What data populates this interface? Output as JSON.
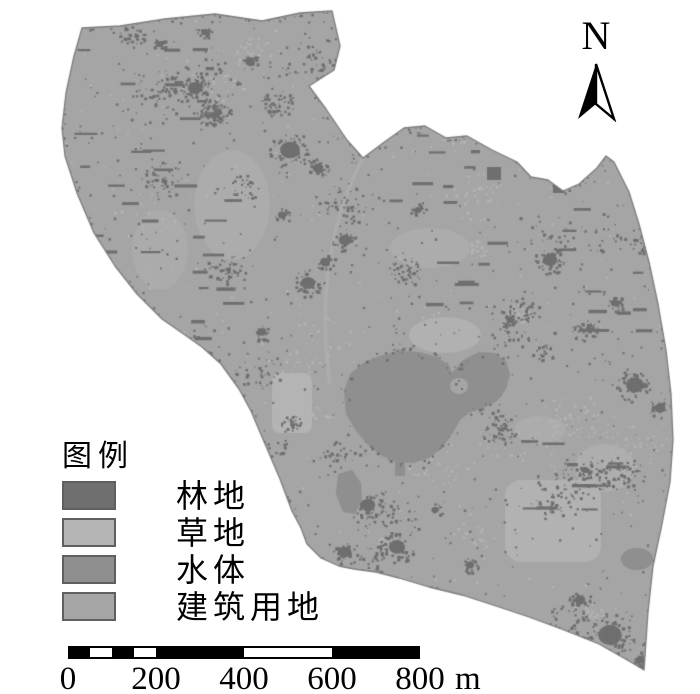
{
  "figure": {
    "type": "land-use-classification-map",
    "north_label": "N",
    "legend": {
      "title": "图例",
      "items": [
        {
          "id": "forest",
          "label": "林地",
          "color": "#6f6f6f"
        },
        {
          "id": "grass",
          "label": "草地",
          "color": "#b4b4b4"
        },
        {
          "id": "water",
          "label": "水体",
          "color": "#8f8f8f"
        },
        {
          "id": "building",
          "label": "建筑用地",
          "color": "#a5a5a5"
        }
      ]
    },
    "scale_bar": {
      "tick_labels": [
        "0",
        "200",
        "400",
        "600",
        "800"
      ],
      "unit": "m",
      "total_meters": 800
    },
    "colors": {
      "background": "#ffffff",
      "map_outline": "#7e7e7e",
      "scalebar_bar": "#000000",
      "text": "#000000"
    }
  }
}
